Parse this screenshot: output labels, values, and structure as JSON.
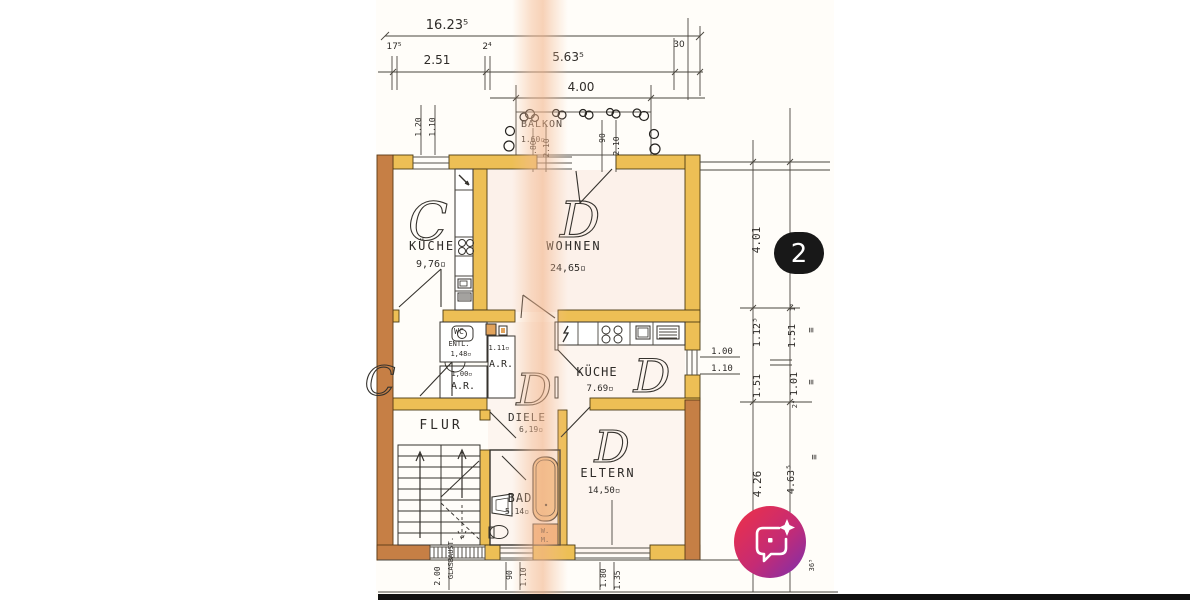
{
  "photo": {
    "kind": "floor-plan-scan",
    "page_indicator": "2"
  },
  "colors": {
    "wall_yellow": "#edbf55",
    "wall_sienna": "#c67f45",
    "fixture_tan": "#f3c48e",
    "line": "#2e2b28",
    "scan_stripe": "#f2bb92",
    "badge_bg": "#181818",
    "fab_gradient_from": "#ef3146",
    "fab_gradient_mid": "#c52b74",
    "fab_gradient_to": "#7b2fae"
  },
  "dims_top": {
    "total": "16.23⁵",
    "left_offset": "17⁵",
    "left": "2.51",
    "mid_offset": "2⁴",
    "main": "5.63⁵",
    "right_offset": "30",
    "balcony_width": "4.00"
  },
  "window_left": {
    "w": "1.20",
    "h": "1.10"
  },
  "balcony": {
    "label": "BALKON",
    "area": "1.60▫",
    "d1": "1.80",
    "d2": "2.10",
    "d3": "90",
    "d4": "2.10"
  },
  "rooms": {
    "kueche_c": {
      "letter": "C",
      "label": "KÜCHE",
      "area": "9,76▫"
    },
    "wohnen": {
      "letter": "D",
      "label": "WOHNEN",
      "area": "24,65▫"
    },
    "wc": {
      "label": "WC",
      "label2": "ENTL.",
      "area": "1,48▫"
    },
    "ar_top": {
      "label": "A.R.",
      "area": "1.11▫"
    },
    "ar_left": {
      "label": "A.R.",
      "area": "1,00▫"
    },
    "kueche_d": {
      "letter": "D",
      "label": "KÜCHE",
      "area": "7.69▫",
      "win_w": "1.00",
      "win_h": "1.10"
    },
    "diele": {
      "letter": "D",
      "label": "DIELE",
      "area": "6,19▫"
    },
    "flur": {
      "label": "FLUR"
    },
    "eltern": {
      "letter": "D",
      "label": "ELTERN",
      "area": "14,50▫"
    },
    "bad": {
      "label": "BAD",
      "area": "5.14▫"
    },
    "wm": {
      "line1": "W.",
      "line2": "M."
    },
    "neighbor": {
      "letter": "C"
    }
  },
  "dims_right": {
    "a": "4.01",
    "b": "1.12⁵",
    "c": "1.51",
    "d": "1.51",
    "e": "1.01",
    "f": "1⁵",
    "g": "2⁴",
    "h": "4.26",
    "i": "4.63⁵",
    "j": "36⁵",
    "eq": "≡"
  },
  "dims_bottom": {
    "a": "2.00",
    "b": "GLASBAUST.",
    "c": "90",
    "d": "1.10",
    "e": "1.80",
    "f": "1.35"
  },
  "badge": {
    "count": "2"
  },
  "fab": {
    "icon": "chat-sparkle-icon"
  }
}
